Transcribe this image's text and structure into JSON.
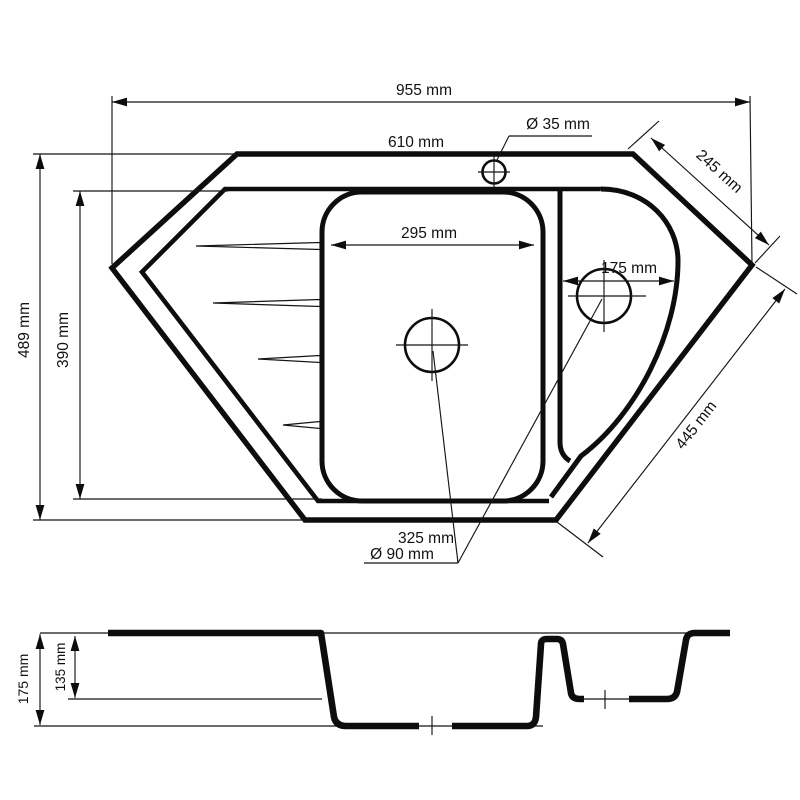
{
  "top_view": {
    "overall_width": "955 mm",
    "top_edge_width": "610 mm",
    "faucet_hole_diameter": "Ø 35 mm",
    "top_right_edge_length": "245 mm",
    "overall_depth": "489 mm",
    "inner_depth": "390 mm",
    "main_bowl_width": "295 mm",
    "small_bowl_width": "175 mm",
    "bottom_right_edge_length": "445 mm",
    "bottom_edge_width": "325 mm",
    "drain_hole_diameter": "Ø 90 mm"
  },
  "section_view": {
    "total_depth": "175 mm",
    "small_bowl_depth": "135 mm"
  }
}
